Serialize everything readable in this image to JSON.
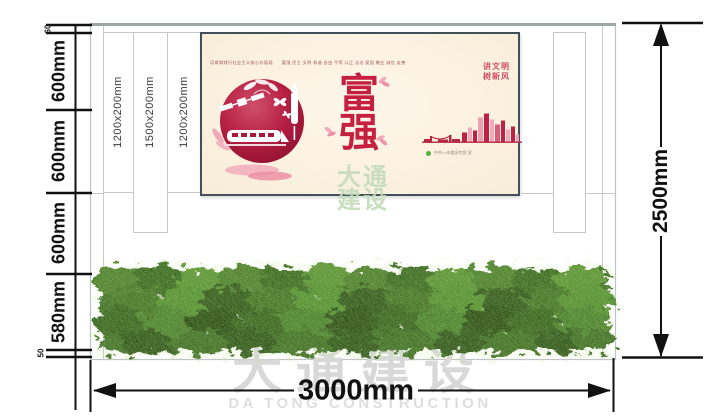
{
  "title": "culture-wall dimension drawing",
  "dimensions": {
    "left_chain": [
      {
        "label": "60"
      },
      {
        "label": "600mm"
      },
      {
        "label": "600mm"
      },
      {
        "label": "600mm"
      },
      {
        "label": "580mm"
      },
      {
        "label": "50"
      }
    ],
    "right_total": "2500mm",
    "bottom_total": "3000mm"
  },
  "wall": {
    "slats": [
      {
        "label": "1200x200mm"
      },
      {
        "label": "1500x200mm"
      },
      {
        "label": "1200x200mm"
      }
    ]
  },
  "poster": {
    "slogan_top": "培育和践行社会主义核心价值观　　富强 民主 文明 和谐 自由 平等 公正 法治 爱国 敬业 诚信 友善",
    "main_chars": "富强",
    "tagline_line1": "讲文明",
    "tagline_line2": "树新风",
    "credit": "中共××市委宣传部 宣"
  },
  "watermark": {
    "center_line1": "大通",
    "center_line2": "建设",
    "bottom_cn": "大通建设",
    "bottom_en": "DA TONG CONSTRUCTION"
  },
  "colors": {
    "dimension_line": "#111111",
    "structure_line": "#bfc3c3",
    "poster_background": "#fbf1e0",
    "poster_border": "#41505a",
    "poster_red": "#c5203f",
    "poster_pink": "#f2aab8",
    "hedge_green": "#43702a",
    "credit_green": "#54b13c",
    "watermark_green": "#c3dcba",
    "watermark_grey": "#d8d8d8"
  }
}
